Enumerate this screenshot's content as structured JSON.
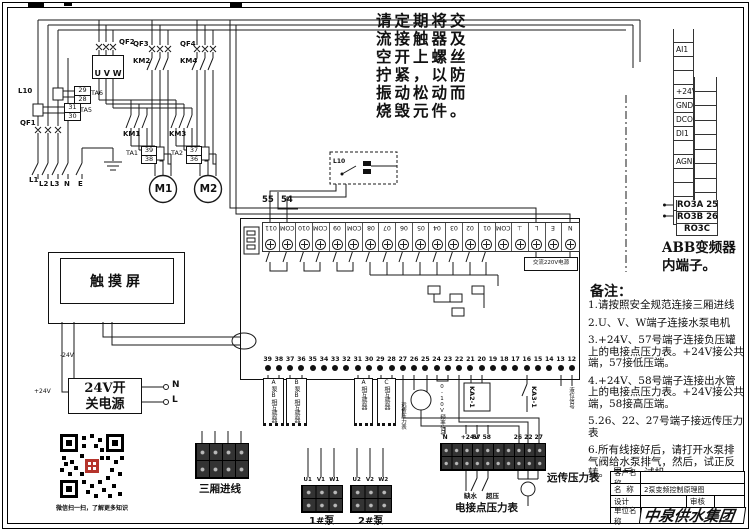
{
  "notice_lines": [
    "请定期将交",
    "流接触器及",
    "空开上螺丝",
    "拧紧，以防",
    "振动松动而",
    "烧毁元件。"
  ],
  "power": {
    "qf1": "QF1",
    "qf2": "QF2",
    "qf3": "QF3",
    "qf4": "QF4",
    "km1": "KM1",
    "km2": "KM2",
    "km3": "KM3",
    "km4": "KM4",
    "uvw": "U V W",
    "l10": "L10",
    "ta6_name": "TA6",
    "ta6_a": "29",
    "ta6_b": "28",
    "ta5_name": "TA5",
    "ta5_a": "31",
    "ta5_b": "30",
    "ta1_name": "TA1",
    "ta1_a": "39",
    "ta1_b": "38",
    "ta2_name": "TA2",
    "ta2_a": "37",
    "ta2_b": "36",
    "m1": "M1",
    "m2": "M2",
    "phase_labels": [
      "L1",
      "L2",
      "L3",
      "N",
      "E"
    ]
  },
  "interlock_box": {
    "l10": "L10",
    "t55": "55",
    "t54": "54"
  },
  "controller": {
    "top_terminals": [
      "011",
      "COM",
      "010",
      "COM",
      "09",
      "COM",
      "08",
      "07",
      "06",
      "05",
      "04",
      "03",
      "02",
      "01",
      "COM",
      "⊥",
      "L",
      "E",
      "N"
    ],
    "bottom_terminals": [
      "39",
      "38",
      "37",
      "36",
      "35",
      "34",
      "33",
      "32",
      "31",
      "30",
      "29",
      "28",
      "27",
      "26",
      "25",
      "24",
      "23",
      "22",
      "21",
      "20",
      "19",
      "18",
      "17",
      "16",
      "15",
      "14",
      "13",
      "12"
    ],
    "power_label": "交流220V电源",
    "ct_labels": [
      "A泵B相互感器",
      "B泵B相互感器",
      "A相互感器",
      "C相互感器"
    ],
    "gauge_label": "远传压力表",
    "freq_label": "0-10V频率信号",
    "ka2": "KA2-1",
    "ka3": "KA3-1",
    "level_label": "液位信号"
  },
  "touchscreen": {
    "title": "触摸屏",
    "neg": "-24V",
    "pos": "+24V"
  },
  "psu": {
    "line1": "24V开",
    "line2": "关电源",
    "n": "N",
    "l": "L"
  },
  "qr_caption": "微信扫一扫，了解更多知识",
  "blocks": {
    "incoming_label": "三厢进线",
    "pump1_terms": [
      "U1",
      "V1",
      "W1"
    ],
    "pump1_label": "1#泵",
    "pump2_terms": [
      "U2",
      "V2",
      "W2"
    ],
    "pump2_label": "2#泵",
    "pressure_top": [
      "N",
      "",
      "+24V",
      "57",
      "58",
      "",
      "",
      "26",
      "22",
      "27"
    ],
    "sw_low": "缺水",
    "sw_high": "超压",
    "pressure_caption": "电接点压力表",
    "remote_caption": "远传压力表"
  },
  "abb": {
    "left_cells": [
      "",
      "AI1",
      "",
      "",
      "+24V",
      "GND",
      "DCOM",
      "DI1",
      "",
      "AGND",
      "",
      "",
      "",
      ""
    ],
    "right_cells": [
      "",
      "",
      "",
      "",
      "",
      "",
      "",
      "",
      "",
      ""
    ],
    "ro_cells": [
      "RO3A 25",
      "RO3B 26",
      "RO3C"
    ],
    "caption1": "ABB变频器",
    "caption2": "内端子。"
  },
  "notes": {
    "title": "备注：",
    "items": [
      "1.请按照安全规范连接三厢进线",
      "2.U、V、W端子连接水泵电机",
      "3.+24V、57号端子连接负压罐上的电接点压力表。+24V接公共端，57接低压端。",
      "4.+24V、58号端子连接出水管上的电接点压力表。+24V接公共端，58接高压端。",
      "5.26、22、27号端子接远传压力表",
      "6.所有线接好后，请打开水泵排气阀给水泵排气，然后，试正反转。 最后，试机。"
    ]
  },
  "titleblock": {
    "customer_label": "客户名称",
    "customer": "",
    "name_label": "名  称",
    "name": "2泵变频控制原理图",
    "design_label": "设计",
    "design": "",
    "review_label": "审核",
    "review": "",
    "company_label": "单位名称",
    "company": "中泉供水集团"
  }
}
